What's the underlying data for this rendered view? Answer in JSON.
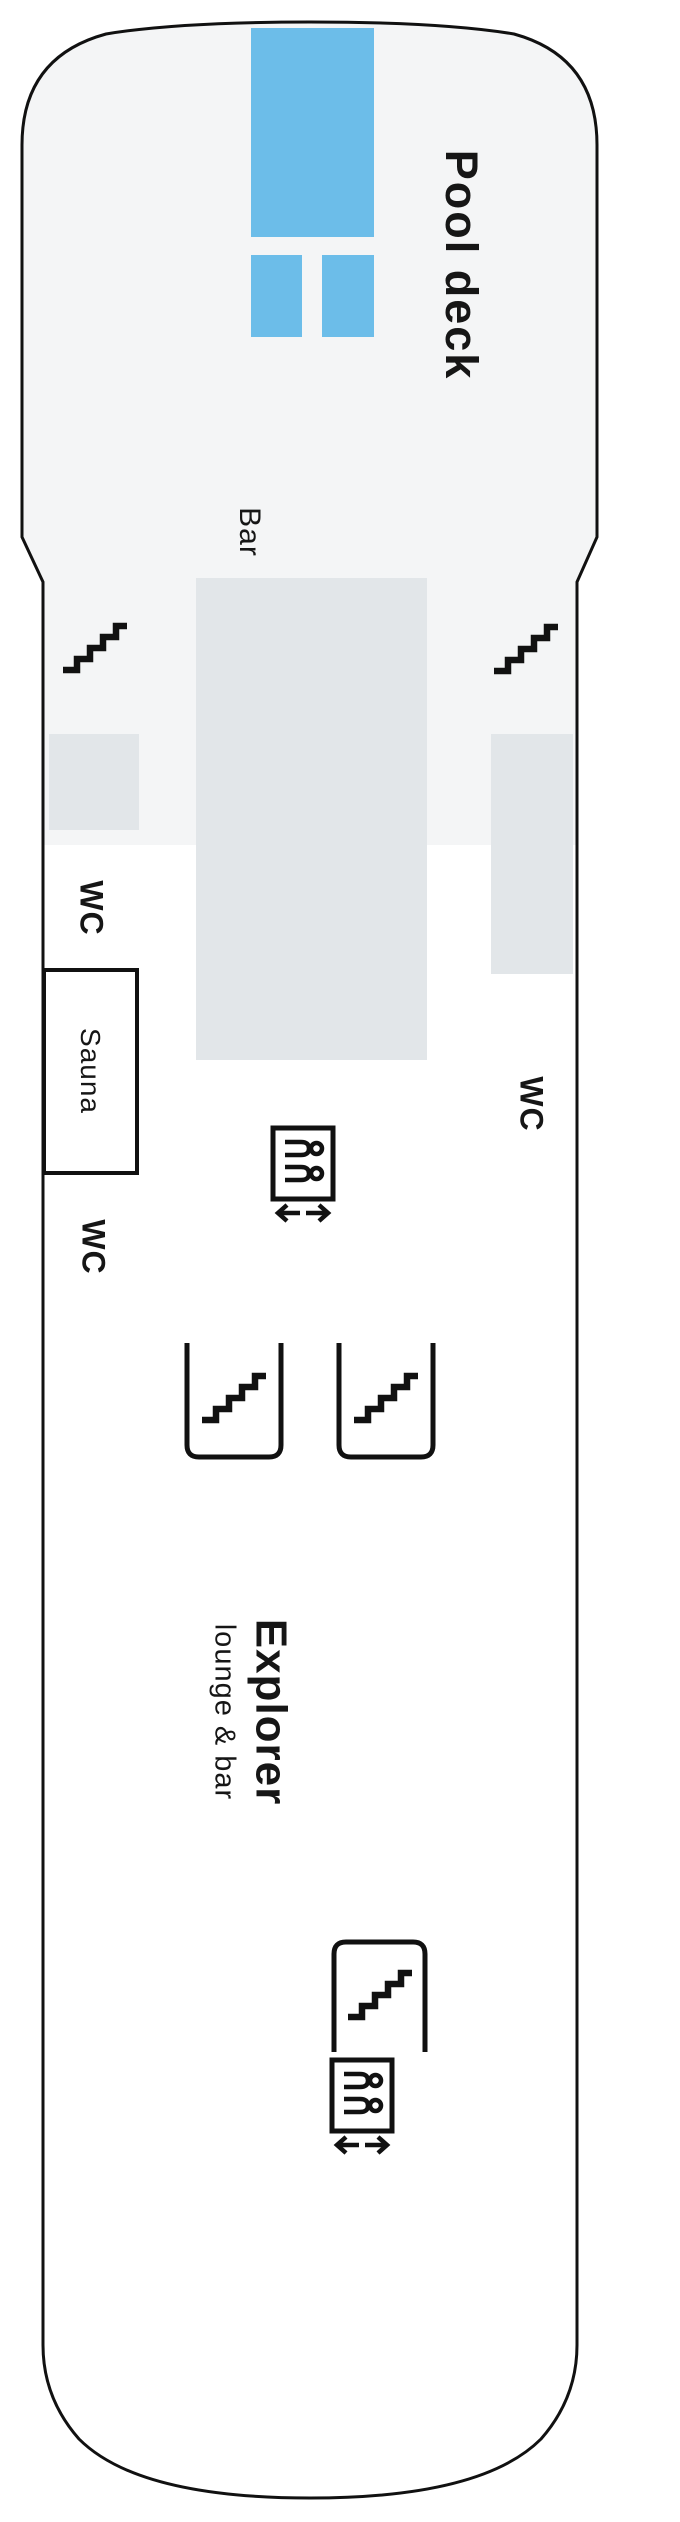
{
  "deck_plan": {
    "pool_deck": {
      "label": "Pool deck"
    },
    "bar": {
      "label": "Bar"
    },
    "wc_forward_port": {
      "label": "WC"
    },
    "wc_starboard": {
      "label": "WC"
    },
    "wc_mid_port": {
      "label": "WC"
    },
    "sauna": {
      "label": "Sauna"
    },
    "explorer": {
      "title": "Explorer",
      "subtitle": "lounge & bar"
    },
    "colors": {
      "pool_blue": "#6cbde9",
      "structure_gray": "#e2e6e9",
      "forward_deck_bg": "#f4f5f6",
      "hull_outline": "#111111"
    },
    "icons": {
      "stairs": "stairs-icon",
      "elevator": "elevator-icon"
    }
  }
}
